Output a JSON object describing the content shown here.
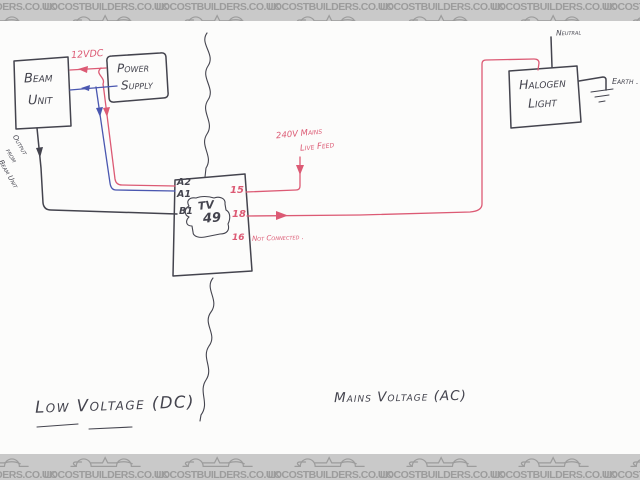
{
  "banner": {
    "brand": "LOCOSTBUILDERS.CO.UK"
  },
  "diagram": {
    "beam_unit": {
      "line1": "Beam",
      "line2": "Unit"
    },
    "power_supply": {
      "line1": "Power",
      "line2": "Supply"
    },
    "supply_label": "12VDC",
    "output_label": {
      "word1": "Output",
      "word2": "from",
      "word3": "Beam Unit"
    },
    "relay": {
      "a2": "A2",
      "a1": "A1",
      "b1": "B1",
      "logo_top": "TV",
      "logo_bottom": "49",
      "t15": "15",
      "t18": "18",
      "t16": "16",
      "not_connected": "Not Connected ."
    },
    "mains_feed": {
      "line1": "240V Mains",
      "line2": "Live Feed"
    },
    "halogen": {
      "line1": "Halogen",
      "line2": "Light"
    },
    "neutral": "Neutral",
    "earth": "Earth .",
    "zone_dc": "Low Voltage (DC)",
    "zone_ac": "Mains Voltage (AC)"
  },
  "colors": {
    "paper": "#fcfcfb",
    "ink_black": "#44444e",
    "ink_red": "#dc5a74",
    "ink_blue": "#4a57b0",
    "banner_bg": "#c9c9c9",
    "banner_text": "#9c9c9c"
  }
}
